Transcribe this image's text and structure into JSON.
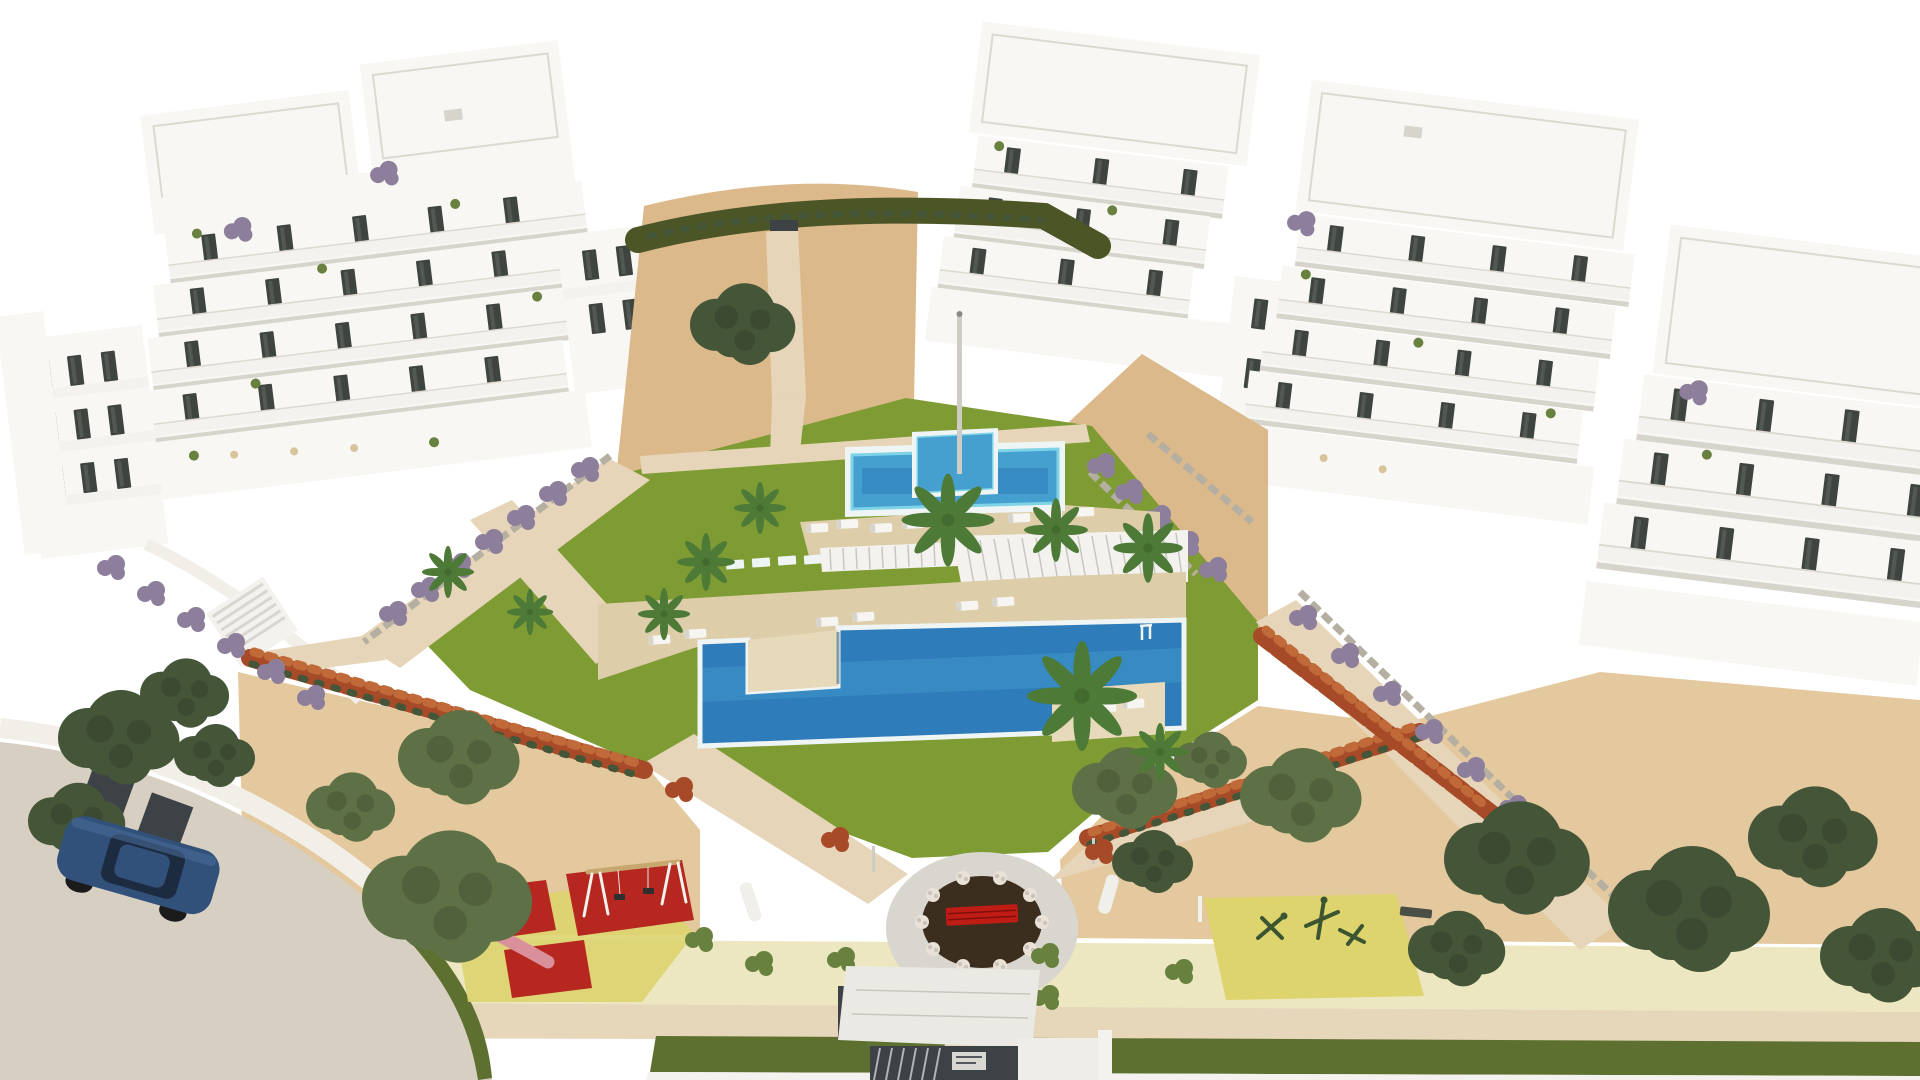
{
  "meta": {
    "title": "New-build apartment complex - aerial 3D architectural render",
    "description": "Bird's-eye architectural visualization of a white modern residential development: two terraced apartment clusters with dark window openings and planted balconies flank a landscaped courtyard containing a lap pool with raised square spa, a large freeform pool with timber deck peninsula, white sun loungers, palm trees, a white louvered pergola over timber lounge cabanas, a circular plaza with a dark planting bed, red bench and white flowering shrubs, a children's playground on red safety mats, an outdoor exercise area on a yellow mat, sandy gardens with olive trees, red flowering hedges, purple shrubs, a dune with clipped hedge behind, an entrance gate with white canopy and dark slatted doors, and a curved access street with a parked dark blue car.",
    "visible_text": "none"
  },
  "palette": {
    "sky": "#ffffff",
    "building": "#f8f7f3",
    "building_shade": "#e9e6e0",
    "building_shadow": "#d7d4cc",
    "building_edge": "#ddd9d1",
    "window": "#3e443f",
    "railing": "#f3f2ee",
    "lawn": "#7e9c33",
    "lawn_dark": "#6f8c2b",
    "sand": "#dcb98b",
    "sand_light": "#e4c89e",
    "dune_hedge": "#4c5526",
    "path_cream": "#e6d5b8",
    "path_pale": "#ece7c0",
    "band_cream": "#e6d6ba",
    "hedge_band": "#5d7030",
    "deck": "#ddcda9",
    "deck_light": "#e7dabb",
    "pool_deep": "#2e7cb9",
    "pool_light": "#45a0d0",
    "pool_coping": "#eff4f5",
    "pool_edge_cyan": "#7ed3e6",
    "pergola_roof": "#f3f2ef",
    "pergola_wood": "#b3946c",
    "pergola_dark": "#262219",
    "plaza_ring": "#d9d6cf",
    "plaza_soil": "#3c2e1e",
    "bench_red": "#bf1c15",
    "bench_white": "#f1efe9",
    "mat_yellow": "#ddd46e",
    "mat_red": "#b5271f",
    "road": "#d8cfc3",
    "curb": "#f2efe9",
    "car": "#31517b",
    "car_glass": "#1d2b41",
    "gate": "#3d4247",
    "canopy": "#ebe9e4",
    "pillar": "#efede8",
    "stone": "#b5afa2",
    "hedge_red": "#a64a28",
    "hedge_red_light": "#c06a3a",
    "shrub_purple": "#8d7f9c",
    "tree_olive": "#5e7045",
    "tree_dark": "#445538",
    "tree_green": "#69813f",
    "palm": "#4e7a37",
    "trunk": "#8d7b5c",
    "lounger": "#f6f5f1",
    "flower_white": "#eae2d7",
    "exercise": "#3c5530",
    "slide_pink": "#d9909a",
    "swing_wood": "#c8a76f",
    "pole": "#cfccc5"
  },
  "scene": {
    "buildings": {
      "left_cluster": "terraced white apartment blocks, roof terraces, dark windows, balcony plants",
      "right_cluster": "terraced white apartment blocks stepping toward courtyard, dark windows"
    },
    "amenities": {
      "upper_pool": "rectangular lap pool with raised square spa and cyan tile edge",
      "main_pool": "large rectangular pool with timber deck peninsula and lounger platform",
      "pergola": "white louvered pergola roof over timber lounge cabanas",
      "plaza": "circular plaza with dark planting bed, red bench, white flowering shrubs, two curved white benches",
      "kids_playground": "red safety mats with swing set, spring rider and pink slide on yellow mat",
      "exercise_area": "yellow mat with dark green outdoor gym equipment and bench",
      "entrance": "white canopy gate with dark vertical-slat doors and white pillar",
      "street": "curved access road with white walls, dark fence panels and parked dark blue car"
    },
    "vegetation": [
      "palm trees",
      "olive trees",
      "dark green trees",
      "purple flowering shrubs",
      "red flowering hedges",
      "clipped dune hedge",
      "lawn panels"
    ],
    "furniture": {
      "sun_loungers": "white sun loungers on travertine decks",
      "stepping_stones": "white stepping-stone path across lawn"
    }
  }
}
